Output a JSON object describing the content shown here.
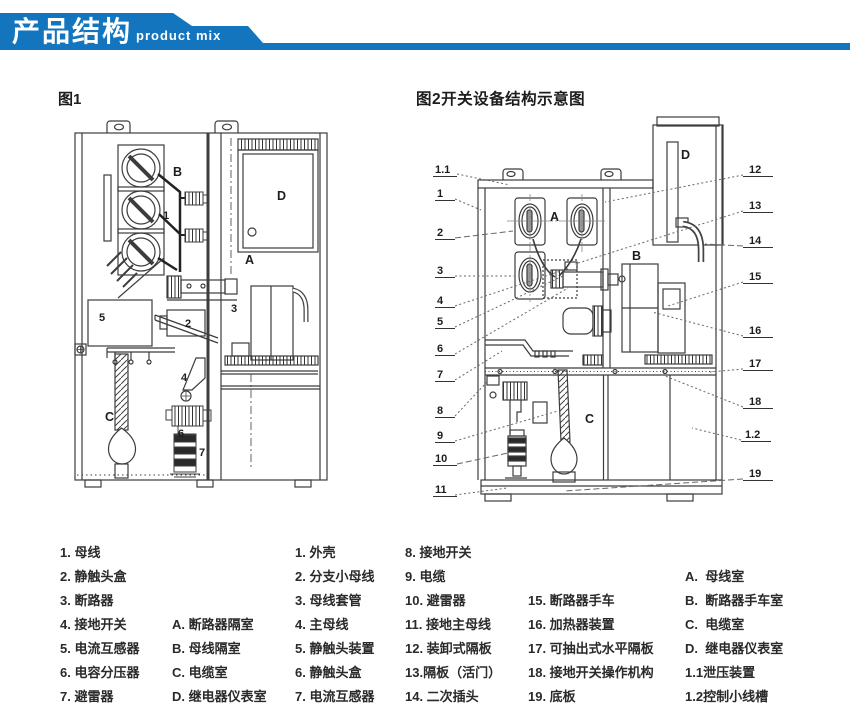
{
  "header": {
    "title_zh": "产品结构",
    "title_en": "product mix",
    "banner_color": "#1375bd"
  },
  "fig1": {
    "title": "图1",
    "part_numbers": [
      "1",
      "2",
      "3",
      "4",
      "5",
      "6",
      "7"
    ],
    "compartment_letters": [
      "A",
      "B",
      "C",
      "D"
    ]
  },
  "fig2": {
    "title": "图2开关设备结构示意图",
    "part_numbers": [
      "1.1",
      "1",
      "2",
      "3",
      "4",
      "5",
      "6",
      "7",
      "8",
      "9",
      "10",
      "11",
      "12",
      "13",
      "14",
      "15",
      "16",
      "17",
      "18",
      "1.2",
      "19"
    ],
    "compartment_letters": [
      "A",
      "B",
      "C",
      "D"
    ]
  },
  "legend": {
    "fig1_parts": [
      "1. 母线",
      "2. 静触头盒",
      "3. 断路器",
      "4. 接地开关",
      "5. 电流互感器",
      "6. 电容分压器",
      "7. 避雷器"
    ],
    "fig1_rooms": [
      "A. 断路器隔室",
      "B. 母线隔室",
      "C. 电缆室",
      "D. 继电器仪表室"
    ],
    "fig2_col1": [
      "1. 外壳",
      "2. 分支小母线",
      "3. 母线套管",
      "4. 主母线",
      "5. 静触头装置",
      "6. 静触头盒",
      "7. 电流互感器"
    ],
    "fig2_col2": [
      "8. 接地开关",
      "9. 电缆",
      "10. 避雷器",
      "11. 接地主母线",
      "12. 装卸式隔板",
      "13.隔板（活门）",
      "14. 二次插头"
    ],
    "fig2_col3": [
      "15. 断路器手车",
      "16. 加热器装置",
      "17. 可抽出式水平隔板",
      "18. 接地开关操作机构",
      "19. 底板"
    ],
    "fig2_rooms": [
      "A.  母线室",
      "B.  断路器手车室",
      "C.  电缆室",
      "D.  继电器仪表室",
      "1.1泄压装置",
      "1.2控制小线槽"
    ]
  }
}
